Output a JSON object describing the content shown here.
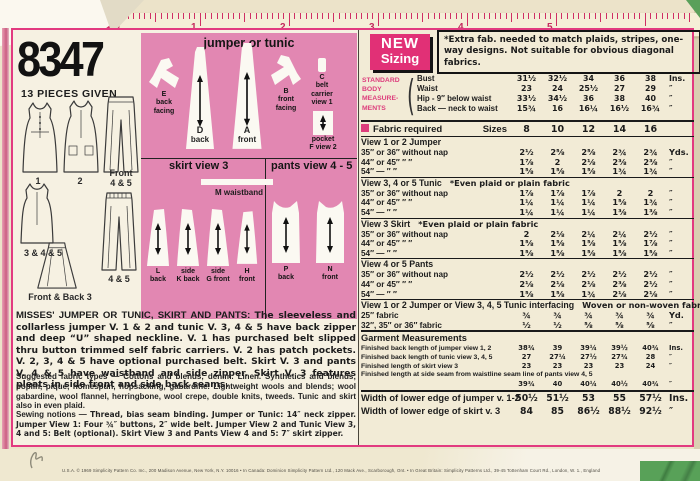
{
  "pattern": {
    "number": "8347",
    "pieces_given": "13 PIECES GIVEN",
    "fineprint": "U.S.A.   © 1969 Simplicity Pattern Co. Inc., 200 Madison Avenue, New York, N.Y. 10016   •  In Canada: Dominion Simplicity Pattern Ltd., 120 Mack Ave., Scarborough, Ont.  •  In Great Britain: Simplicity Patterns Ltd., 39-45 Tottenham Court Rd., London, W. 1., England"
  },
  "ruler": {
    "label": "Measure",
    "numbers": [
      "1",
      "2",
      "3",
      "4",
      "5"
    ]
  },
  "views": {
    "labels": [
      [
        "1"
      ],
      [
        "2"
      ],
      [
        "Front",
        "4 & 5"
      ],
      [
        "3 & 4 & 5"
      ],
      [
        "4 & 5"
      ],
      [
        "Front & Back  3"
      ]
    ]
  },
  "piece_box": {
    "title": "jumper or tunic",
    "divider_left": "skirt  view 3",
    "divider_right": "pants view 4 - 5",
    "waistband_label": "M  waistband",
    "pieces": [
      {
        "id": "E",
        "lines": [
          "E",
          "back",
          "facing"
        ]
      },
      {
        "id": "D",
        "lines": [
          "D",
          "back"
        ]
      },
      {
        "id": "A",
        "lines": [
          "A",
          "front"
        ]
      },
      {
        "id": "B",
        "lines": [
          "B",
          "front",
          "facing"
        ]
      },
      {
        "id": "C",
        "lines": [
          "C",
          "belt",
          "carrier",
          "view 1"
        ]
      },
      {
        "id": "F",
        "lines": [
          "pocket",
          "F view 2"
        ]
      },
      {
        "id": "L",
        "lines": [
          "L",
          "back"
        ]
      },
      {
        "id": "K",
        "lines": [
          "side",
          "K back"
        ]
      },
      {
        "id": "G",
        "lines": [
          "side",
          "G front"
        ]
      },
      {
        "id": "H",
        "lines": [
          "H",
          "front"
        ]
      },
      {
        "id": "P",
        "lines": [
          "P",
          "back"
        ]
      },
      {
        "id": "N",
        "lines": [
          "N",
          "front"
        ]
      }
    ]
  },
  "description": {
    "headline": "MISSES' JUMPER OR TUNIC, SKIRT AND PANTS:",
    "body": "The sleeveless and collarless jumper V. 1 & 2 and tunic V. 3, 4 & 5 have back zipper and deep “U” shaped neckline. V. 1 has purchased belt slipped thru button trimmed self fabric carriers. V. 2 has patch pockets. V. 2, 3, 4 & 5 have optional purchased belt. Skirt V. 3 and pants V. 4 & 5 have waistband and side zipper. Skirt V. 3 features pleats in side front and side back seams.",
    "fabrics_label": "Suggested fabric types —",
    "fabrics": "Cottons and blends; denim. Linen. Synthetics and blends; poplin, pique, homespun, hopsacking, gabardine. Lightweight wools and blends; wool gabardine, wool flannel, herringbone, wool crepe, double knits, tweeds. Tunic and skirt also in even plaid.",
    "notions_label": "Sewing notions —",
    "notions": "Thread, bias seam binding. Jumper or Tunic: 14″ neck zipper. Jumper View 1: Four ¾″ buttons, 2″ wide belt. Jumper View 2 and Tunic View 3, 4 and 5: Belt (optional). Skirt View 3 and Pants View 4 and 5: 7″ skirt zipper."
  },
  "sizing": {
    "badge_line1": "NEW",
    "badge_line2": "Sizing",
    "note": "*Extra fab. needed to match plaids, stripes, one-way designs. Not suitable for obvious diagonal fabrics.",
    "body": {
      "label_lines": [
        "STANDARD",
        "BODY",
        "MEASURE-",
        "MENTS"
      ],
      "rows": [
        {
          "label": "Bust",
          "values": [
            "31½",
            "32½",
            "34",
            "36",
            "38"
          ],
          "unit": "Ins."
        },
        {
          "label": "Waist",
          "values": [
            "23",
            "24",
            "25½",
            "27",
            "29"
          ],
          "unit": "″"
        },
        {
          "label": "Hip - 9″ below waist",
          "values": [
            "33½",
            "34½",
            "36",
            "38",
            "40"
          ],
          "unit": "″"
        },
        {
          "label": "Back — neck to waist",
          "values": [
            "15¾",
            "16",
            "16¼",
            "16½",
            "16¾"
          ],
          "unit": "″"
        }
      ]
    },
    "fabric_required": {
      "title": "Fabric required",
      "sizes_label": "Sizes",
      "sizes": [
        "8",
        "10",
        "12",
        "14",
        "16"
      ],
      "sections": [
        {
          "heading": "View 1 or 2   Jumper",
          "note": "",
          "rows": [
            {
              "label": "35″ or 36″ without nap",
              "values": [
                "2½",
                "2⅝",
                "2⅝",
                "2¾",
                "2¾"
              ],
              "unit": "Yds."
            },
            {
              "label": "44″ or 45″      ″      ″",
              "values": [
                "1⅞",
                "2",
                "2⅛",
                "2⅜",
                "2⅜"
              ],
              "unit": "″"
            },
            {
              "label": "54″   —      ″      ″",
              "values": [
                "1⅝",
                "1⅝",
                "1⅝",
                "1¾",
                "1¾"
              ],
              "unit": "″"
            }
          ]
        },
        {
          "heading": "View 3, 4 or 5   Tunic",
          "note": "*Even plaid or plain fabric",
          "rows": [
            {
              "label": "35″ or 36″ without nap",
              "values": [
                "1⅞",
                "1⅞",
                "1⅞",
                "2",
                "2"
              ],
              "unit": "″"
            },
            {
              "label": "44″ or 45″      ″      ″",
              "values": [
                "1¼",
                "1¼",
                "1¼",
                "1⅝",
                "1¾"
              ],
              "unit": "″"
            },
            {
              "label": "54″   —      ″      ″",
              "values": [
                "1¼",
                "1¼",
                "1¼",
                "1⅜",
                "1⅜"
              ],
              "unit": "″"
            }
          ]
        },
        {
          "heading": "View 3   Skirt",
          "note": "*Even plaid or plain fabric",
          "rows": [
            {
              "label": "35″ or 36″ without nap",
              "values": [
                "2",
                "2⅛",
                "2¼",
                "2¼",
                "2½"
              ],
              "unit": "″"
            },
            {
              "label": "44″ or 45″      ″      ″",
              "values": [
                "1⅝",
                "1⅝",
                "1⅝",
                "1⅝",
                "1⅞"
              ],
              "unit": "″"
            },
            {
              "label": "54″   —      ″      ″",
              "values": [
                "1⅝",
                "1⅝",
                "1⅝",
                "1⅝",
                "1⅝"
              ],
              "unit": "″"
            }
          ]
        },
        {
          "heading": "View 4 or 5   Pants",
          "note": "",
          "rows": [
            {
              "label": "35″ or 36″ without nap",
              "values": [
                "2½",
                "2½",
                "2½",
                "2½",
                "2½"
              ],
              "unit": "″"
            },
            {
              "label": "44″ or 45″      ″      ″",
              "values": [
                "2⅛",
                "2⅛",
                "2⅛",
                "2⅜",
                "2½"
              ],
              "unit": "″"
            },
            {
              "label": "54″   —      ″      ″",
              "values": [
                "1⅝",
                "1⅝",
                "1¾",
                "2⅛",
                "2⅛"
              ],
              "unit": "″"
            }
          ]
        },
        {
          "heading": "View 1 or 2 Jumper or View 3, 4, 5 Tunic interfacing",
          "note": "Woven or non-woven fabric",
          "between": true,
          "rows": [
            {
              "label": "25″ fabric",
              "values": [
                "¾",
                "¾",
                "¾",
                "¾",
                "¾"
              ],
              "unit": "Yd."
            },
            {
              "label": "32″, 35″ or 36″ fabric",
              "values": [
                "½",
                "½",
                "⅝",
                "⅝",
                "⅝"
              ],
              "unit": "″"
            }
          ]
        }
      ]
    },
    "garment_measurements": {
      "heading": "Garment Measurements",
      "rows": [
        {
          "label": "Finished back length of jumper view 1, 2",
          "values": [
            "38¾",
            "39",
            "39¼",
            "39½",
            "40¾"
          ],
          "unit": "Ins."
        },
        {
          "label": "Finished back length of tunic view 3, 4, 5",
          "values": [
            "27",
            "27¼",
            "27½",
            "27¾",
            "28"
          ],
          "unit": "″"
        },
        {
          "label": "Finished length of skirt view 3",
          "values": [
            "23",
            "23",
            "23",
            "23",
            "24"
          ],
          "unit": "″"
        },
        {
          "label": "Finished length at side seam from waistline seam line of pants view 4, 5",
          "values": [
            "39¾",
            "40",
            "40¼",
            "40½",
            "40¾"
          ],
          "unit": "″",
          "wrap": true
        }
      ]
    },
    "lower_edge": {
      "rows": [
        {
          "label": "Width of lower edge of jumper v. 1-2",
          "values": [
            "50½",
            "51½",
            "53",
            "55",
            "57½"
          ],
          "unit": "Ins."
        },
        {
          "label": "Width of lower edge of skirt v. 3",
          "values": [
            "84",
            "85",
            "86½",
            "88½",
            "92½"
          ],
          "unit": "″"
        }
      ]
    }
  },
  "colors": {
    "accent_pink": "#e13076",
    "piece_box_pink": "#e287b2",
    "ruler_tick": "#cf2f63",
    "border_magenta": "#e23a80",
    "green_corner": "#58a158"
  }
}
